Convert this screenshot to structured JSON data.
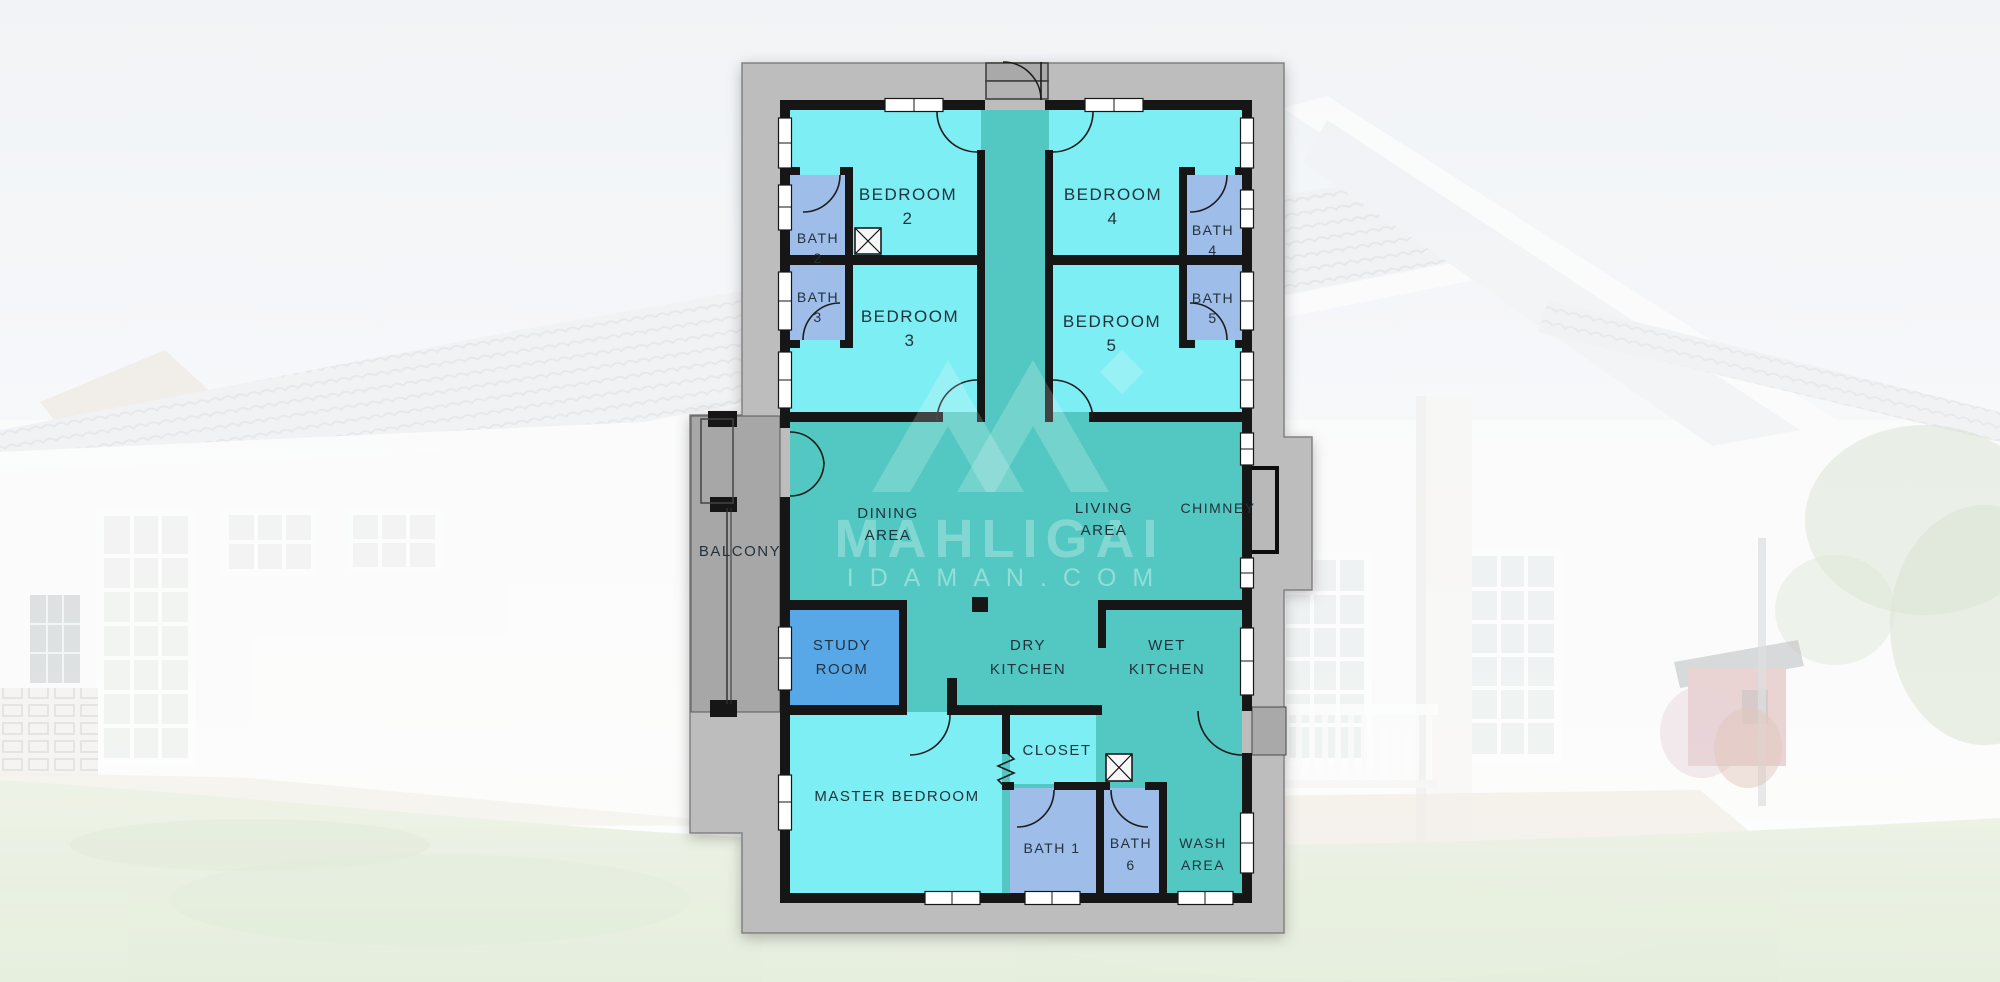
{
  "watermark": {
    "brand": "MAHLIGAI",
    "domain": "IDAMAN.COM"
  },
  "rooms": {
    "bedroom2": {
      "label": "BEDROOM",
      "num": "2"
    },
    "bedroom3": {
      "label": "BEDROOM",
      "num": "3"
    },
    "bedroom4": {
      "label": "BEDROOM",
      "num": "4"
    },
    "bedroom5": {
      "label": "BEDROOM",
      "num": "5"
    },
    "bath2": {
      "label": "BATH",
      "num": "2"
    },
    "bath3": {
      "label": "BATH",
      "num": "3"
    },
    "bath4": {
      "label": "BATH",
      "num": "4"
    },
    "bath5": {
      "label": "BATH",
      "num": "5"
    },
    "bath1": {
      "label": "BATH 1"
    },
    "bath6": {
      "label": "BATH",
      "num": "6"
    },
    "balcony": {
      "label": "BALCONY"
    },
    "dining": {
      "line1": "DINING",
      "line2": "AREA"
    },
    "living": {
      "line1": "LIVING",
      "line2": "AREA"
    },
    "chimney": {
      "label": "CHIMNEY"
    },
    "study": {
      "line1": "STUDY",
      "line2": "ROOM"
    },
    "dry_kitchen": {
      "line1": "DRY",
      "line2": "KITCHEN"
    },
    "wet_kitchen": {
      "line1": "WET",
      "line2": "KITCHEN"
    },
    "closet": {
      "label": "CLOSET"
    },
    "master_bedroom": {
      "label": "MASTER BEDROOM"
    },
    "wash_area": {
      "line1": "WASH",
      "line2": "AREA"
    }
  },
  "colors": {
    "bedroom": "#7deef3",
    "hall": "#52c8c2",
    "bath": "#9fbde9",
    "study": "#58a8e7",
    "slab": "#bdbdbd",
    "balcony_floor": "#a7a7a7",
    "wall": "#141414",
    "label_text": "#24323c",
    "watermark": "#ffffff"
  }
}
